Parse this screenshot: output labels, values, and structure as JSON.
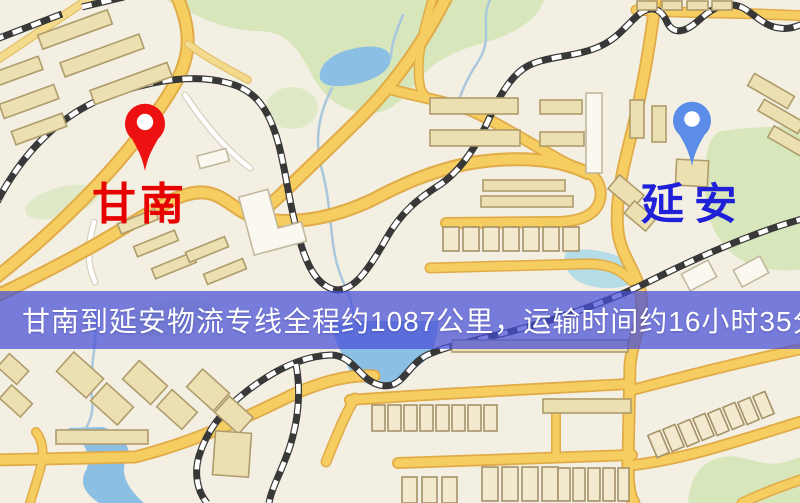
{
  "map": {
    "origin": {
      "label": "甘南"
    },
    "destination": {
      "label": "延安"
    },
    "banner": {
      "text": "甘南到延安物流专线全程约1087公里，运输时间约16小时35分钟."
    },
    "colors": {
      "origin_label": "#e60000",
      "origin_pin": "#ee1111",
      "destination_label": "#2020d8",
      "destination_pin": "#5a8ce8",
      "banner_bg": "rgba(70,78,215,0.72)",
      "road_fill": "#f6cd60",
      "road_casing": "#e0ab48",
      "park": "#d7e6bb",
      "water": "#8cbfe4",
      "background": "#f3efe3"
    }
  }
}
